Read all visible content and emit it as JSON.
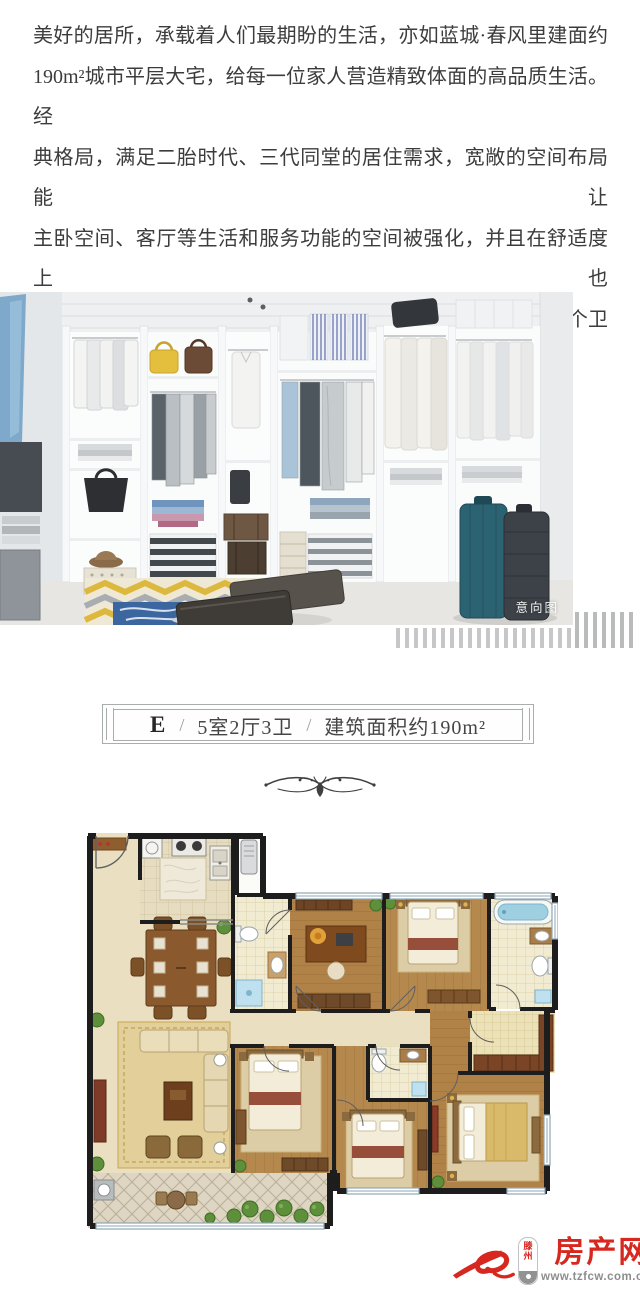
{
  "intro": {
    "lines": [
      "美好的居所，承载着人们最期盼的生活，亦如蓝城·春风里建面约",
      "190m²城市平层大宅，给每一位家人营造精致体面的高品质生活。经",
      "典格局，满足二胎时代、三代同堂的居住需求，宽敞的空间布局能让",
      "主卧空间、客厅等生活和服务功能的空间被强化，并且在舒适度上也",
      "更加贴合中、高端人群需求。主卧、父母房套房设计、配置3个卫生",
      "间、独立衣帽间等设计，让美好生活更加便捷私密。"
    ]
  },
  "photo": {
    "caption": "意向图"
  },
  "plaque": {
    "unit": "E",
    "separator": "/",
    "layout": "5室2厅3卫",
    "area": "建筑面积约190m²"
  },
  "logo": {
    "city_top": "滕",
    "city_bottom": "州",
    "brand": "房产网",
    "url": "www.tzfcw.com.cn",
    "accent_color": "#d7281f"
  },
  "colors": {
    "body_text": "#3c3c3c",
    "plaque_border": "#a9adad",
    "logo_red": "#d7281f"
  }
}
